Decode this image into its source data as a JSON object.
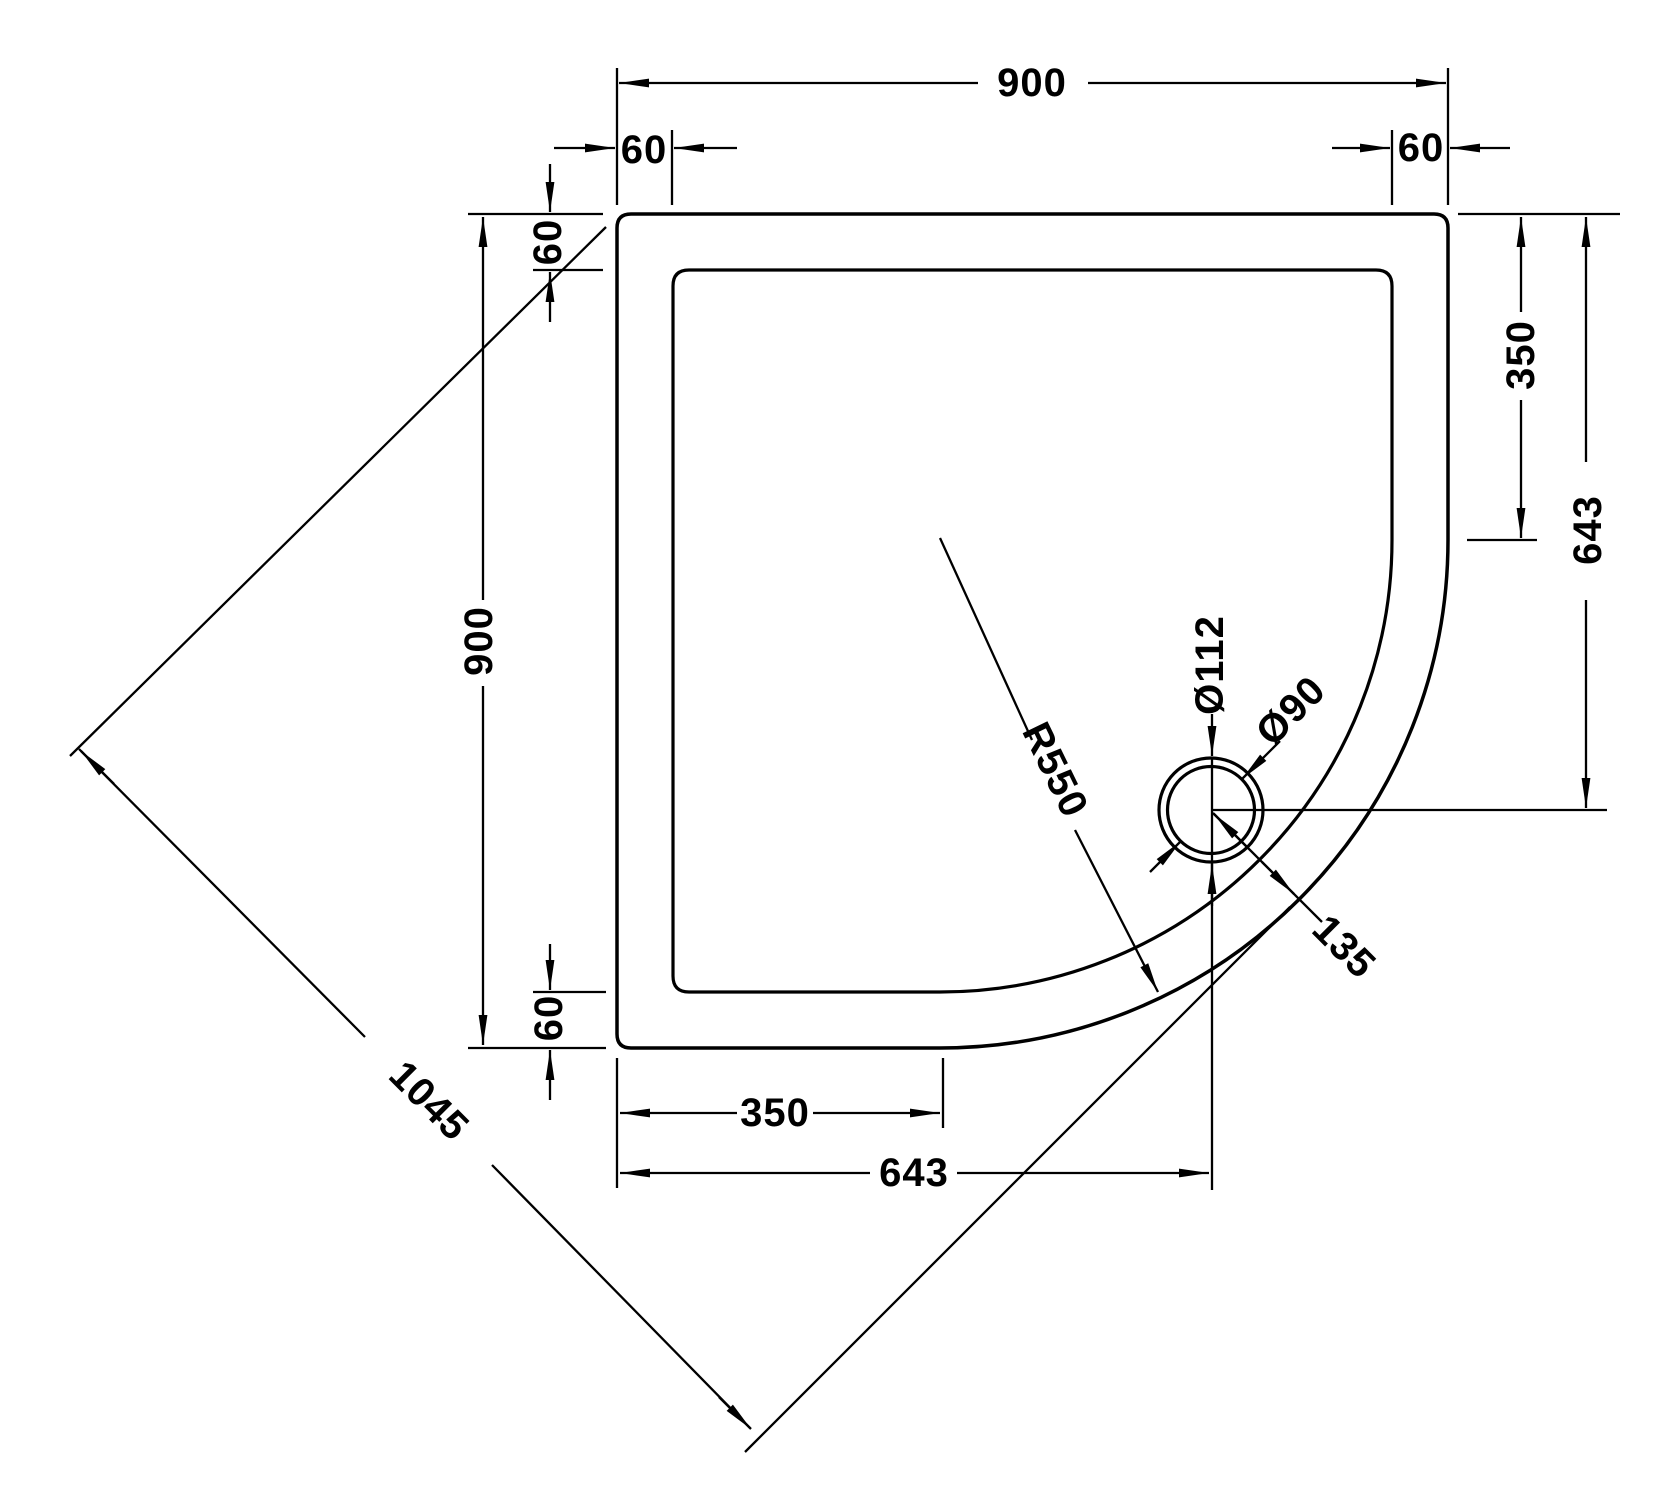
{
  "page": {
    "background": "#ffffff",
    "line_color": "#000000"
  },
  "dimensions_mm": {
    "top_width": "900",
    "top_left_rim_inset": "60",
    "top_right_rim_inset": "60",
    "left_top_rim_inset": "60",
    "left_depth": "900",
    "left_bottom_rim_inset": "60",
    "right_edge_to_curve_start": "350",
    "right_edge_to_drain_centre": "643",
    "drain_outer_diameter": "Ø112",
    "drain_waste_diameter": "Ø90",
    "front_corner_radius": "R550",
    "drain_centre_to_curved_edge": "135",
    "bottom_edge_to_curve_start": "350",
    "bottom_edge_to_drain_centre": "643",
    "diagonal_across_curve": "1045"
  }
}
